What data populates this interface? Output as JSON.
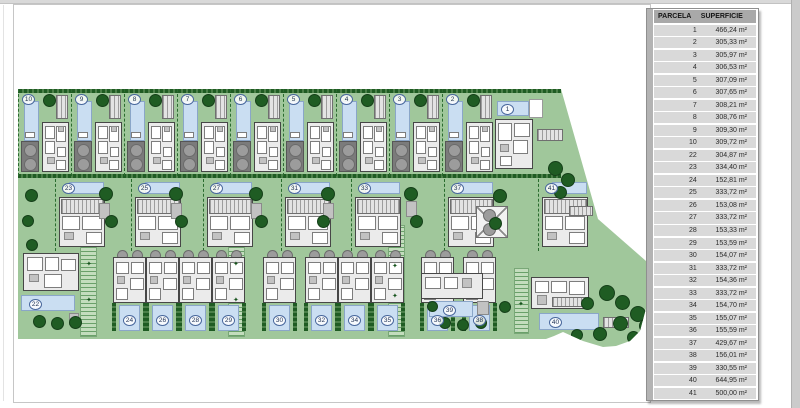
{
  "table": {
    "headers": [
      "PARCELA",
      "SUPERFICIE"
    ],
    "rows": [
      [
        "1",
        "466,24 m²"
      ],
      [
        "2",
        "305,33 m²"
      ],
      [
        "3",
        "305,97 m²"
      ],
      [
        "4",
        "306,53 m²"
      ],
      [
        "5",
        "307,09 m²"
      ],
      [
        "6",
        "307,65 m²"
      ],
      [
        "7",
        "308,21 m²"
      ],
      [
        "8",
        "308,76 m²"
      ],
      [
        "9",
        "309,30 m²"
      ],
      [
        "10",
        "309,72 m²"
      ],
      [
        "22",
        "304,87 m²"
      ],
      [
        "23",
        "334,40 m²"
      ],
      [
        "24",
        "152,81 m²"
      ],
      [
        "25",
        "333,72 m²"
      ],
      [
        "26",
        "153,08 m²"
      ],
      [
        "27",
        "333,72 m²"
      ],
      [
        "28",
        "153,33 m²"
      ],
      [
        "29",
        "153,59 m²"
      ],
      [
        "30",
        "154,07 m²"
      ],
      [
        "31",
        "333,72 m²"
      ],
      [
        "32",
        "154,36 m²"
      ],
      [
        "33",
        "333,72 m²"
      ],
      [
        "34",
        "154,70 m²"
      ],
      [
        "35",
        "155,07 m²"
      ],
      [
        "36",
        "155,59 m²"
      ],
      [
        "37",
        "429,67 m²"
      ],
      [
        "38",
        "156,01 m²"
      ],
      [
        "39",
        "330,55 m²"
      ],
      [
        "40",
        "644,95 m²"
      ],
      [
        "41",
        "500,00 m²"
      ]
    ]
  },
  "plan": {
    "plots": {
      "top": [
        "10",
        "9",
        "8",
        "7",
        "6",
        "5",
        "4",
        "3",
        "2"
      ],
      "plot1": "1",
      "middle": [
        "23",
        "25",
        "27",
        "31",
        "33",
        "37",
        "41"
      ],
      "bottom": [
        "24",
        "26",
        "28",
        "29",
        "30",
        "32",
        "34",
        "35",
        "36",
        "38"
      ],
      "plot22": "22",
      "plot39": "39",
      "plot40": "40"
    },
    "decor": {
      "star_char": "✦"
    },
    "colors": {
      "site_green": "#a0c79b",
      "hedge_green": "#1f5c23",
      "pool_blue": "#cadef2",
      "building_gray": "#ebebeb",
      "table_row_gray": "#d9d9d9",
      "table_header_gray": "#a9a9a9"
    }
  }
}
